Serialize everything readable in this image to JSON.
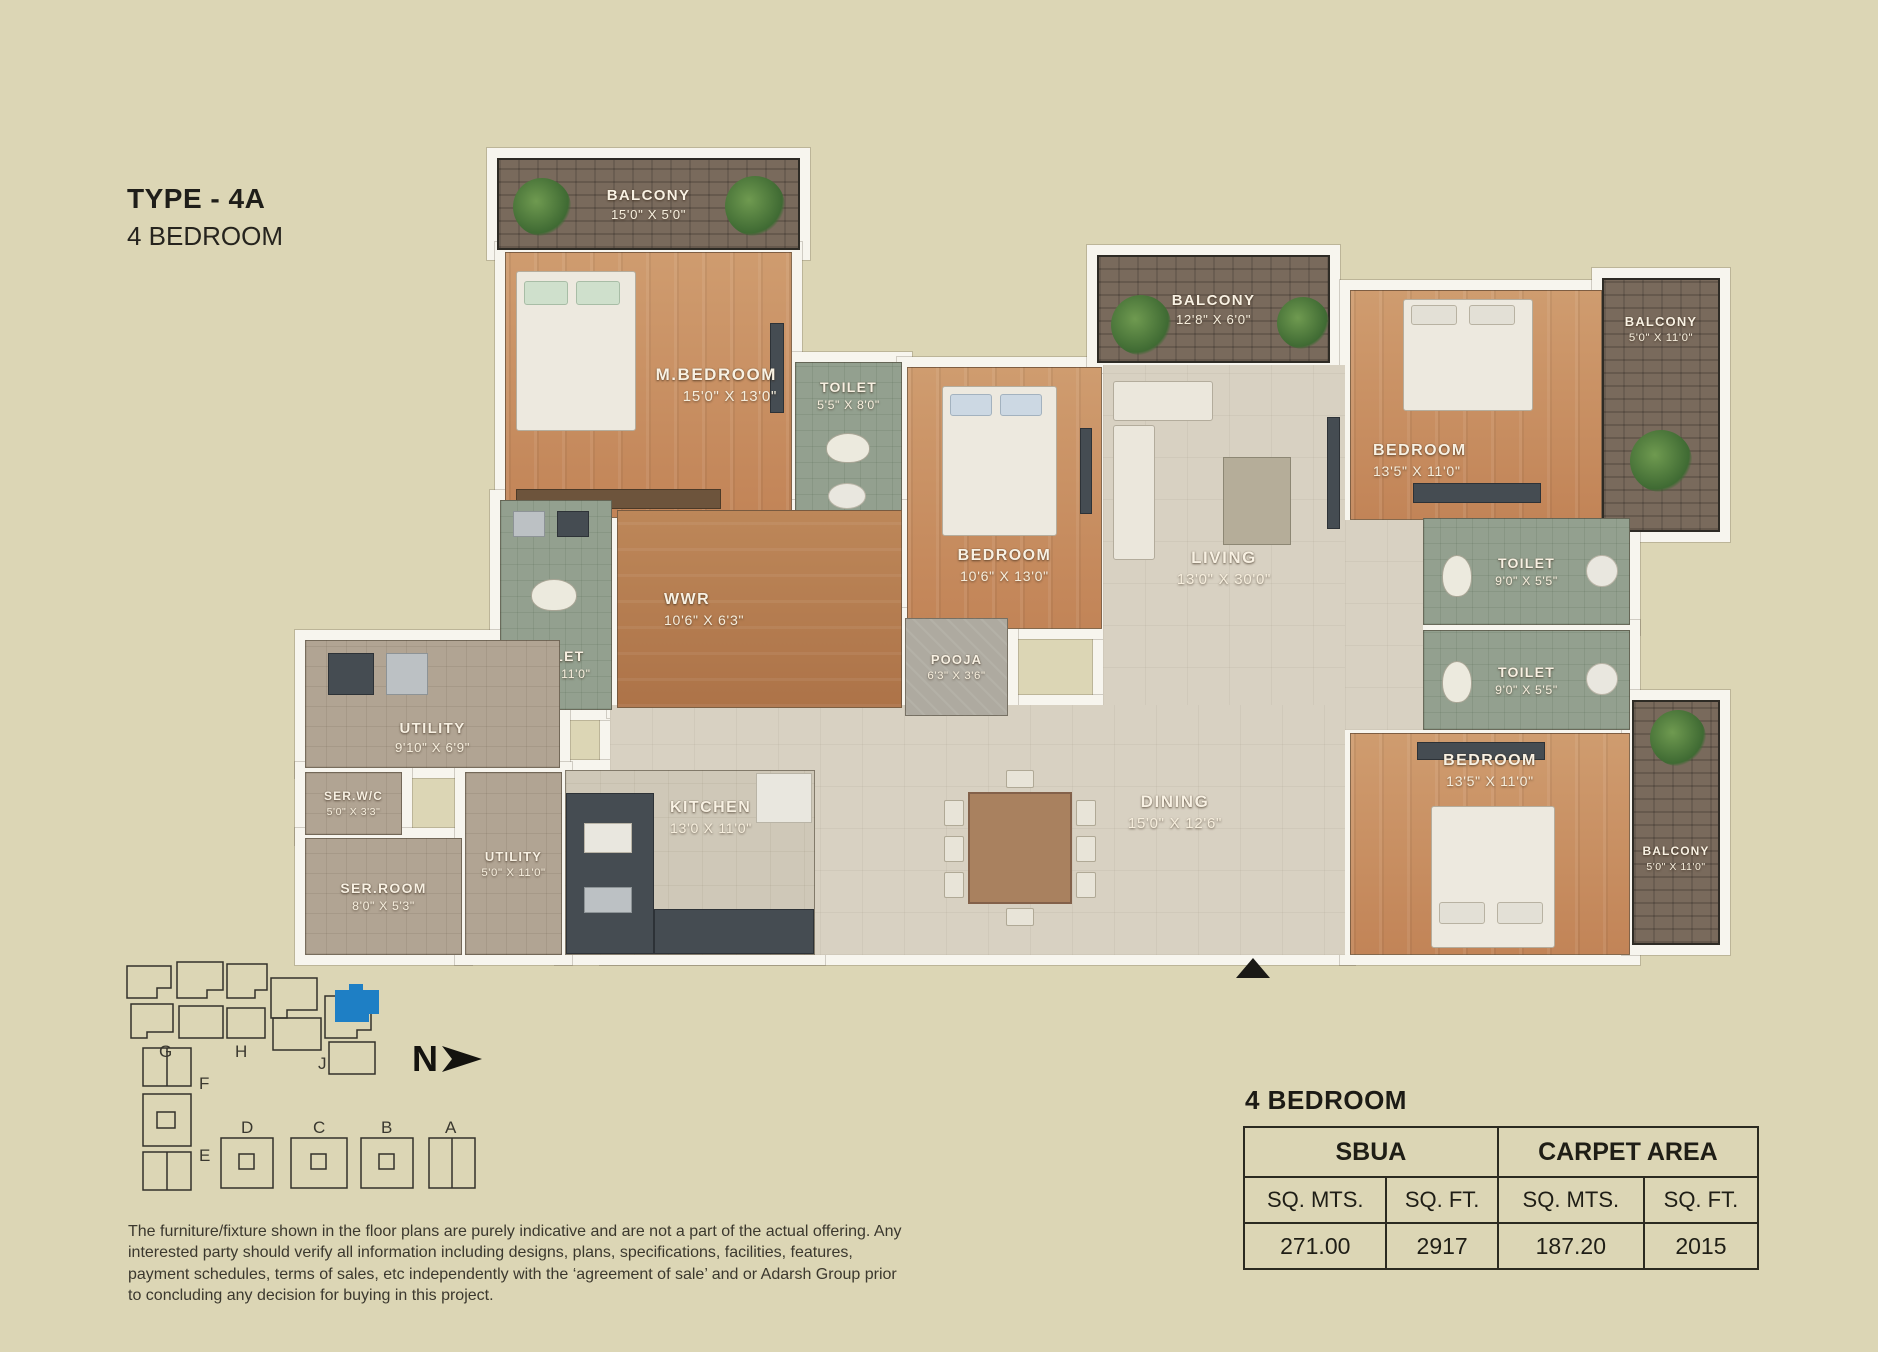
{
  "title": {
    "line1": "TYPE - 4A",
    "line2": "4 BEDROOM"
  },
  "rooms": [
    {
      "name": "BALCONY",
      "dims": "15'0\" X 5'0\""
    },
    {
      "name": "M.BEDROOM",
      "dims": "15'0\" X 13'0\""
    },
    {
      "name": "TOILET",
      "dims": "5'5\" X 8'0\""
    },
    {
      "name": "BEDROOM",
      "dims": "10'6\" X 13'0\""
    },
    {
      "name": "BALCONY",
      "dims": "12'8\" X 6'0\""
    },
    {
      "name": "LIVING",
      "dims": "13'0\" X 30'0\""
    },
    {
      "name": "BEDROOM",
      "dims": "13'5\" X 11'0\""
    },
    {
      "name": "BALCONY",
      "dims": "5'0\" X 11'0\""
    },
    {
      "name": "TOILET",
      "dims": "9'0\" X 5'5\""
    },
    {
      "name": "TOILET",
      "dims": "9'0\" X 5'5\""
    },
    {
      "name": "BEDROOM",
      "dims": "13'5\" X 11'0\""
    },
    {
      "name": "BALCONY",
      "dims": "5'0\" X 11'0\""
    },
    {
      "name": "TOILET",
      "dims": "5'7\" X 11'0\""
    },
    {
      "name": "WWR",
      "dims": "10'6\" X 6'3\""
    },
    {
      "name": "POOJA",
      "dims": "6'3\" X 3'6\""
    },
    {
      "name": "DINING",
      "dims": "15'0\" X 12'6\""
    },
    {
      "name": "KITCHEN",
      "dims": "13'0 X 11'0\""
    },
    {
      "name": "UTILITY",
      "dims": "9'10\" X 6'9\""
    },
    {
      "name": "SER.W/C",
      "dims": "5'0\" X 3'3\""
    },
    {
      "name": "SER.ROOM",
      "dims": "8'0\" X 5'3\""
    },
    {
      "name": "UTILITY",
      "dims": "5'0\" X 11'0\""
    }
  ],
  "north": {
    "label": "N"
  },
  "key_plan": {
    "labels": {
      "g": "G",
      "h": "H",
      "j": "J",
      "f": "F",
      "e": "E",
      "d": "D",
      "c": "C",
      "b": "B",
      "a": "A"
    },
    "highlight_color": "#1e7fc5"
  },
  "disclaimer": {
    "text": "The furniture/fixture shown in the floor plans are purely indicative and are not a part of the actual offering. Any interested party should verify all information including designs, plans, specifications, facilities, features, payment schedules, terms of sales, etc independently with the ‘agreement of sale’ and or Adarsh Group prior to concluding any decision for buying in this project."
  },
  "summary": {
    "heading": "4 BEDROOM",
    "groups": [
      "SBUA",
      "CARPET AREA"
    ],
    "unit_headers": [
      "SQ. MTS.",
      "SQ. FT.",
      "SQ. MTS.",
      "SQ. FT."
    ],
    "values": [
      "271.00",
      "2917",
      "187.20",
      "2015"
    ]
  },
  "colors": {
    "background": "#dcd6b5",
    "wall": "#f7f5ee",
    "wood_floor": "#c89066",
    "tile_floor": "#d8d1c2",
    "toilet_floor": "#93a08f",
    "balcony_brick": "#796a5c",
    "utility_floor": "#b1a493",
    "counter": "#454c52",
    "key_plan_highlight": "#1e7fc5",
    "label_text": "#f8f1e3",
    "dark_text": "#23211c"
  }
}
